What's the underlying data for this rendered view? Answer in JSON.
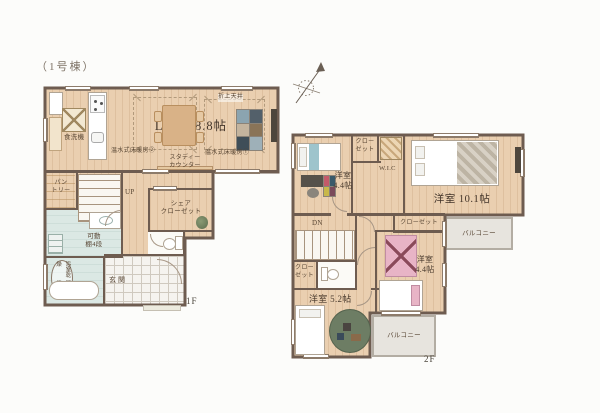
{
  "meta": {
    "building_label": "（1号棟）"
  },
  "colors": {
    "background": "#fcfcfa",
    "wood_floor": "#eacfb0",
    "wall": "#6e5c50",
    "water_room": "#dbe8e4",
    "tile": "#f5f3ef",
    "balcony": "#e7e4de",
    "label_text": "#4a3c30",
    "accent_pink": "#e8b4c6",
    "accent_green": "#6d7d64",
    "table_wood": "#d9b287"
  },
  "floor1": {
    "floor_label": "1F",
    "labels": {
      "ldk": "LDK 18.8帖",
      "coffered_ceiling": "折上天井",
      "floor_heating_1": "温水式床暖房①",
      "floor_heating_2": "温水式床暖房②",
      "study_counter_1": "スタディー",
      "study_counter_2": "カウンター",
      "dishwasher": "食洗機",
      "pantry_1": "パン",
      "pantry_2": "トリー",
      "stairs_up": "UP",
      "share_closet_1": "シェア",
      "share_closet_2": "クローゼット",
      "movable_shelf_1": "可動",
      "movable_shelf_2": "棚4段",
      "bath_dryer_1": "浴室乾燥",
      "bath_dryer_2": "暖房機",
      "entrance": "玄関"
    }
  },
  "floor2": {
    "floor_label": "2F",
    "labels": {
      "room_nw_1": "洋室",
      "room_nw_2": "4.4帖",
      "closet_north_1": "クロー",
      "closet_north_2": "ゼット",
      "wic": "W.I.C",
      "room_east": "洋室 10.1帖",
      "closet_center": "クローゼット",
      "balcony_east": "バルコニー",
      "stairs_down": "DN",
      "closet_west_1": "クロー",
      "closet_west_2": "ゼット",
      "room_se_1": "洋室",
      "room_se_2": "4.4帖",
      "room_sw": "洋室 5.2帖",
      "balcony_south": "バルコニー"
    }
  }
}
